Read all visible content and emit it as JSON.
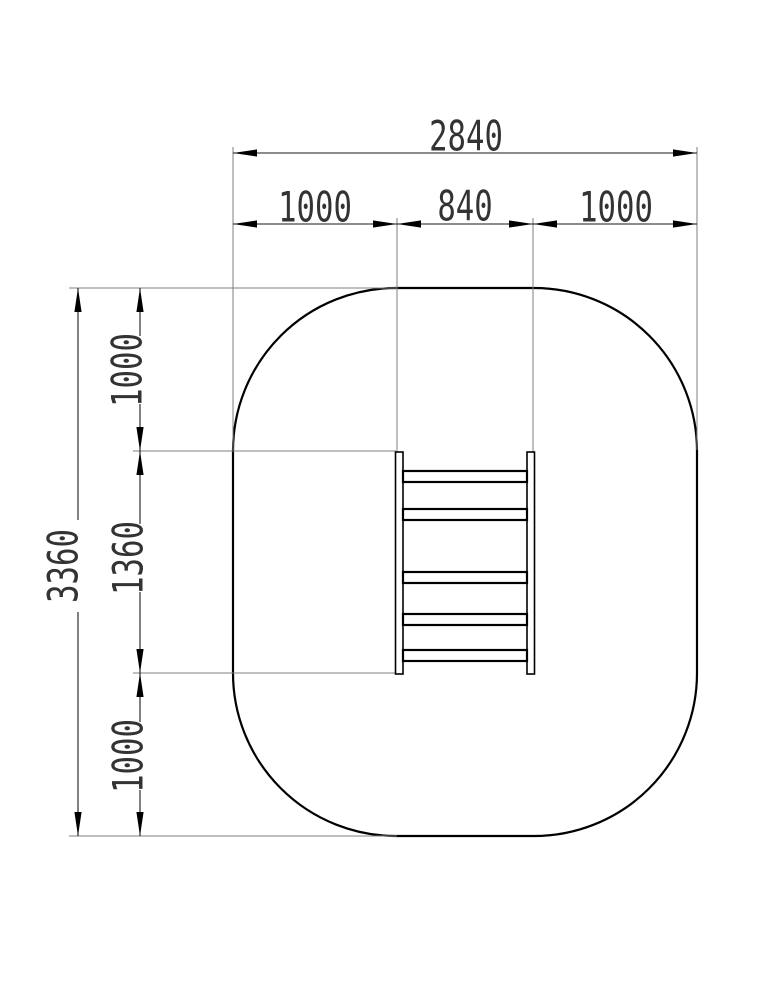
{
  "drawing": {
    "horizontal_dimensions": {
      "total": "2840",
      "left": "1000",
      "middle": "840",
      "right": "1000"
    },
    "vertical_dimensions": {
      "total": "3360",
      "top": "1000",
      "middle": "1360",
      "bottom": "1000"
    }
  },
  "colors": {
    "outline": "#000000",
    "dimension_line": "#1a1a1a",
    "extension_line": "#7f7f7f",
    "text": "#333333",
    "background": "#ffffff"
  }
}
